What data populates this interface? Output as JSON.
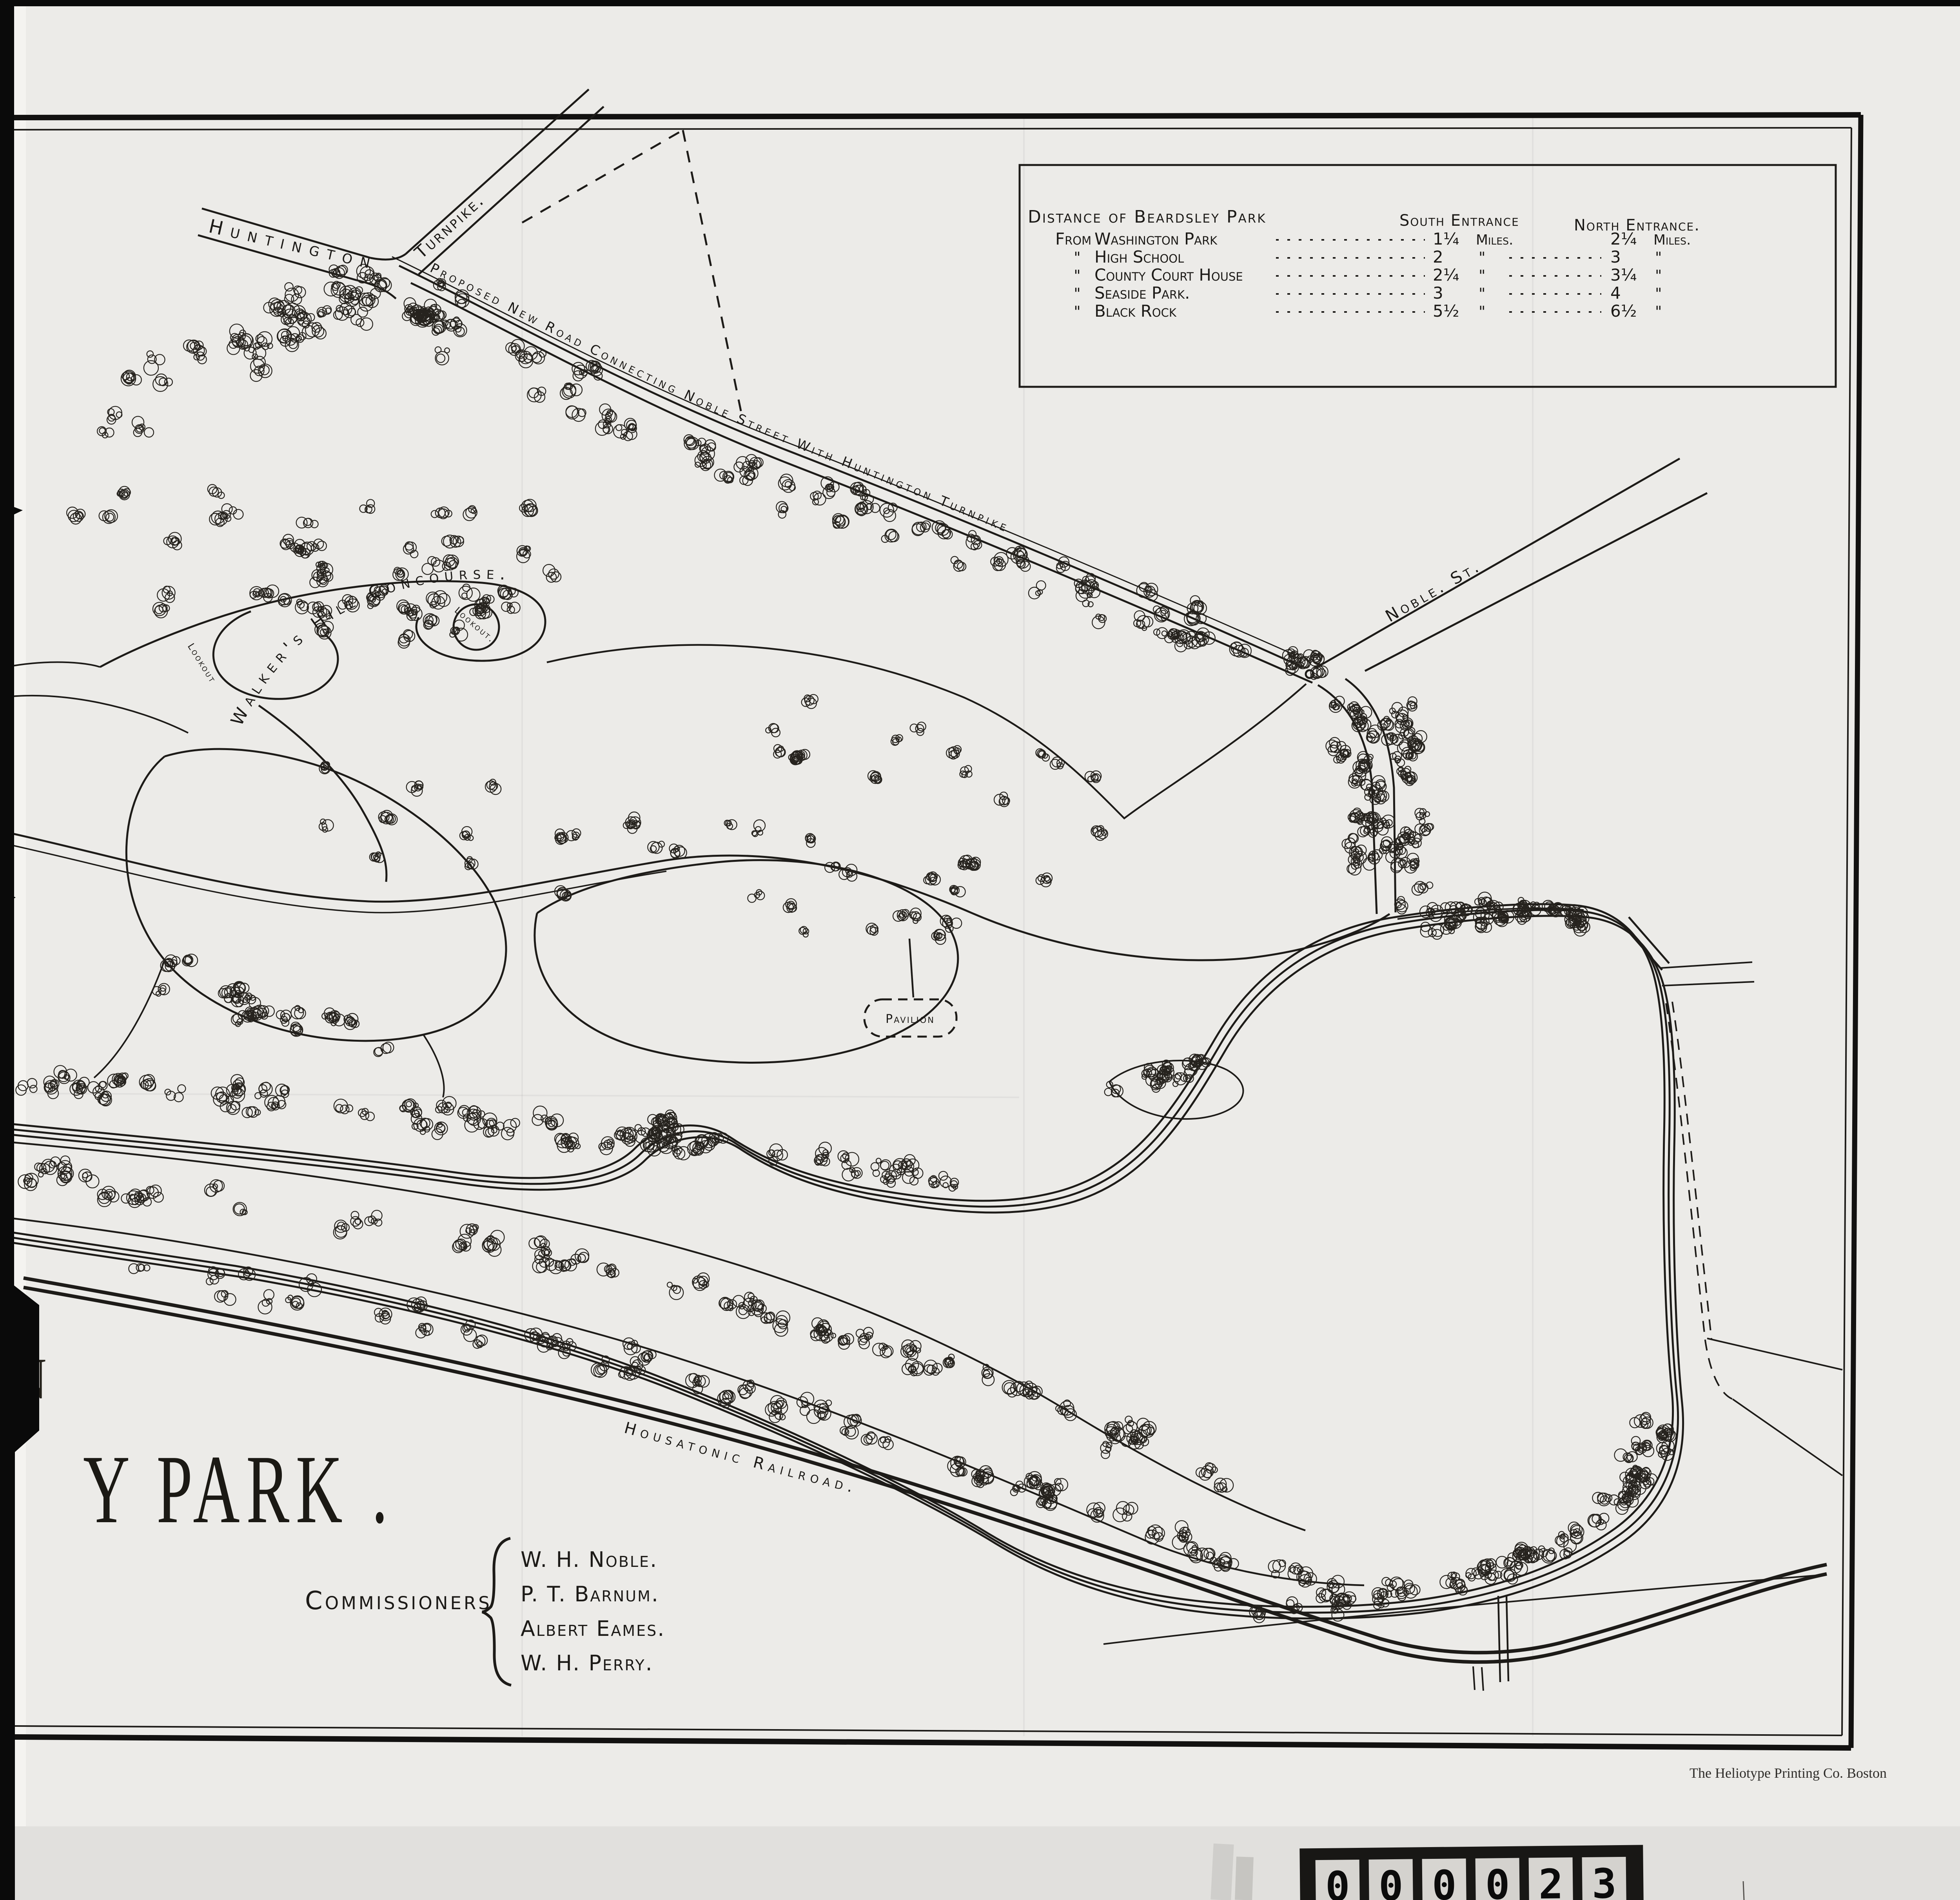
{
  "map": {
    "title_fragment": "Y PARK .",
    "title_partial_letter": "N",
    "credit": "The Heliotype Printing Co. Boston",
    "roads": {
      "huntington": "Huntington",
      "turnpike": "Turnpike.",
      "proposed_new_road": "Proposed New Road Connecting Noble Street With Huntington Turnpike",
      "noble_st": "Noble. St.",
      "railroad": "Housatonic Railroad."
    },
    "features": {
      "concourse": "Walker's Hill Concourse.",
      "lookout_west": "Lookout",
      "lookout_east": "Lookout.",
      "pavilion": "Pavilion"
    },
    "commissioners": {
      "label": "Commissioners",
      "names": [
        "W. H. Noble.",
        "P. T. Barnum.",
        "Albert Eames.",
        "W. H. Perry."
      ]
    },
    "distance_table": {
      "title": "Distance of Beardsley Park",
      "col_south": "South Entrance",
      "col_north": "North Entrance.",
      "rows": [
        {
          "from": "From",
          "place": "Washington Park",
          "south": "1¼",
          "south_unit": "Miles.",
          "north": "2¼",
          "north_unit": "Miles."
        },
        {
          "from": "\"",
          "place": "High School",
          "south": "2",
          "south_unit": "\"",
          "north": "3",
          "north_unit": "\""
        },
        {
          "from": "\"",
          "place": "County Court House",
          "south": "2¼",
          "south_unit": "\"",
          "north": "3¼",
          "north_unit": "\""
        },
        {
          "from": "\"",
          "place": "Seaside Park.",
          "south": "3",
          "south_unit": "\"",
          "north": "4",
          "north_unit": "\""
        },
        {
          "from": "\"",
          "place": "Black Rock",
          "south": "5½",
          "south_unit": "\"",
          "north": "6½",
          "north_unit": "\""
        }
      ]
    },
    "counter": {
      "digits": [
        "0",
        "0",
        "0",
        "0",
        "2",
        "3"
      ]
    }
  }
}
